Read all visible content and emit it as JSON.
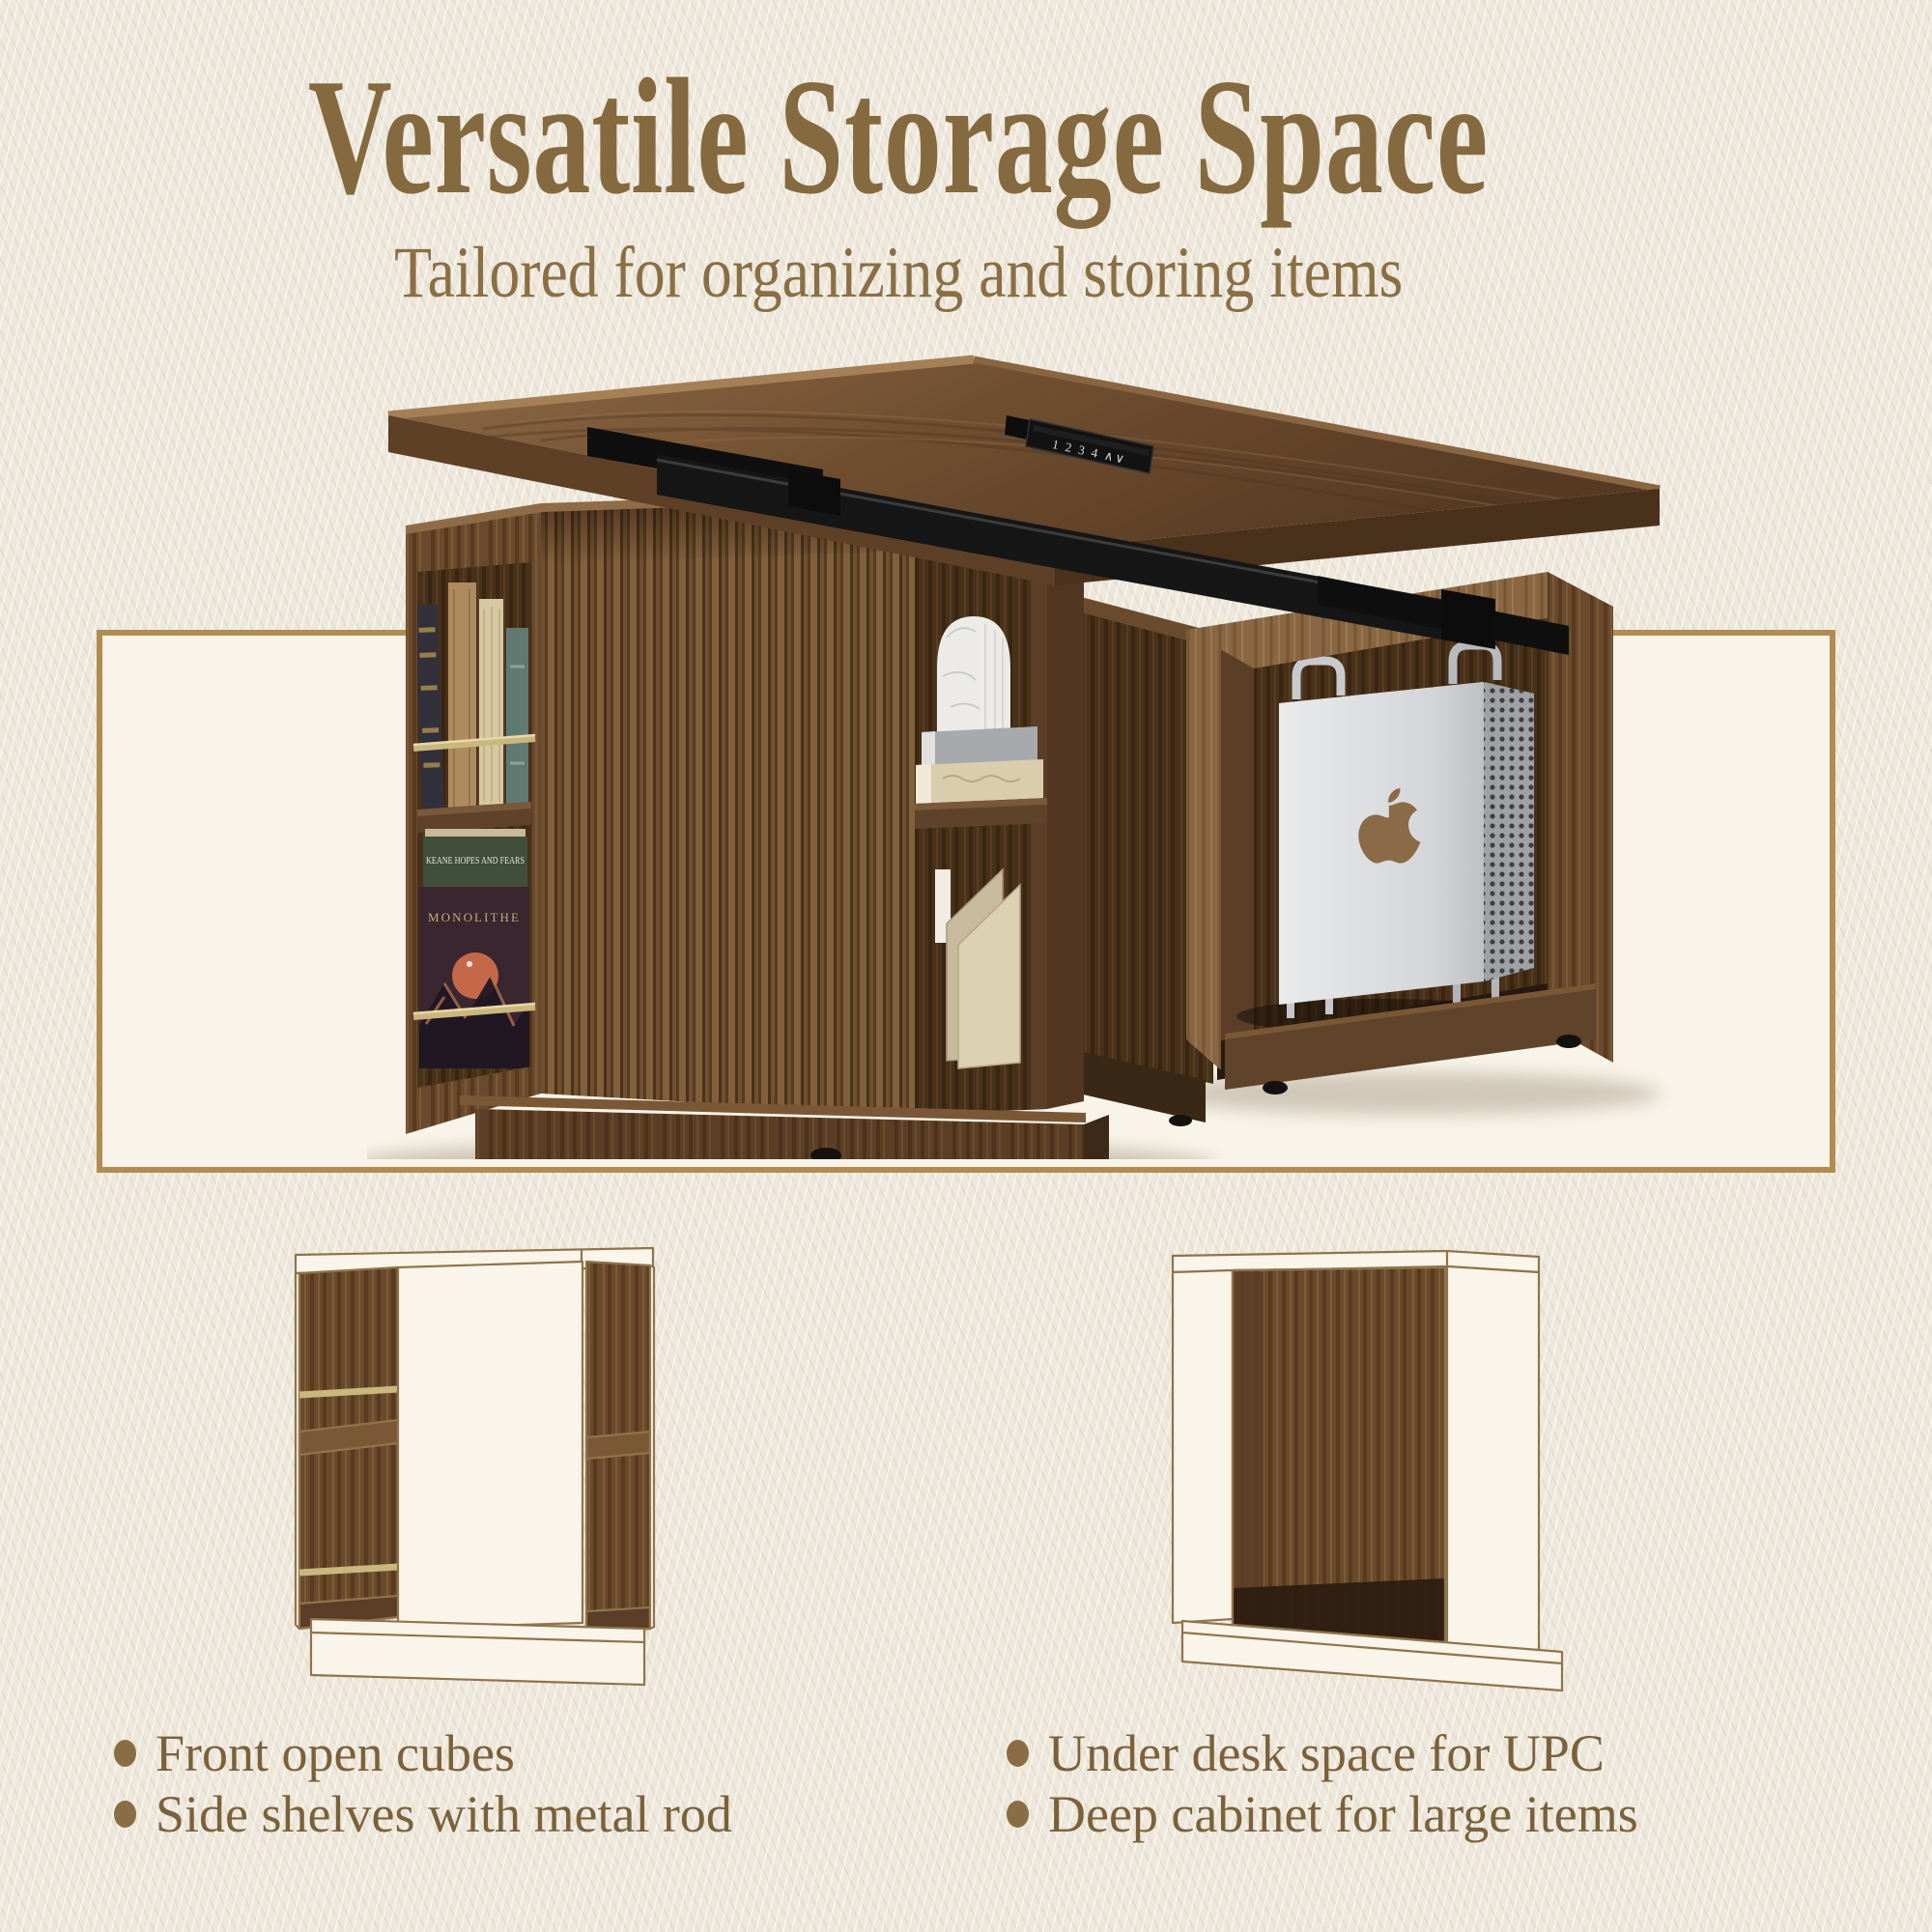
{
  "header": {
    "title": "Versatile Storage Space",
    "subtitle": "Tailored for organizing and storing items"
  },
  "hero": {
    "keypad_label": "1 2 3 4 ∧∨",
    "vinyl_back_title": "KEANE HOPES AND FEARS",
    "vinyl_front_title": "MONOLITHE"
  },
  "features": {
    "left": [
      "Front open cubes",
      "Side shelves with metal rod"
    ],
    "right": [
      "Under desk space for UPC",
      "Deep cabinet for large items"
    ]
  },
  "colors": {
    "background": "#eee8dc",
    "accent_text": "#85693f",
    "bullet_dot": "#8a6d44",
    "panel_fill": "#f9f4e9",
    "panel_border": "#b08c53",
    "diagram_line": "#8f744b",
    "brass_rod": "#c9b77e",
    "walnut_dark": "#483119",
    "walnut_mid": "#6a4a2c",
    "walnut_light": "#8a6744",
    "desk_frame_black": "#161616",
    "mac_silver": "#d4d5d8"
  }
}
